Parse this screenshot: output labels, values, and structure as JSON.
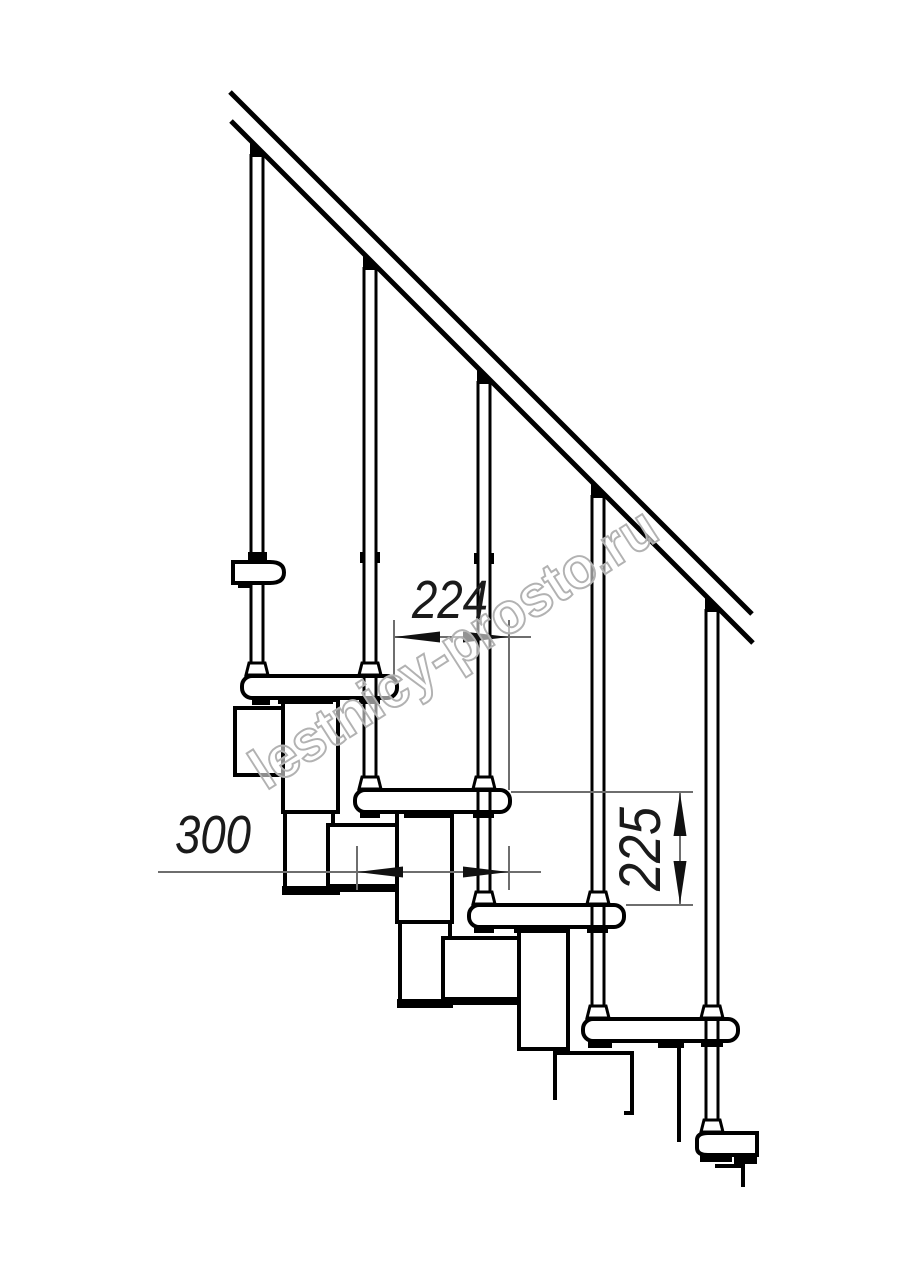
{
  "drawing": {
    "dimensions": {
      "going": "224",
      "depth": "300",
      "rise": "225"
    },
    "watermark": "lestnicy-prosto.ru",
    "colors": {
      "line": "#000000",
      "dimension_line": "#6e6e6e",
      "dimension_text": "#1a1a1a",
      "watermark_outline": "#b2b2b2",
      "background": "#ffffff"
    }
  }
}
